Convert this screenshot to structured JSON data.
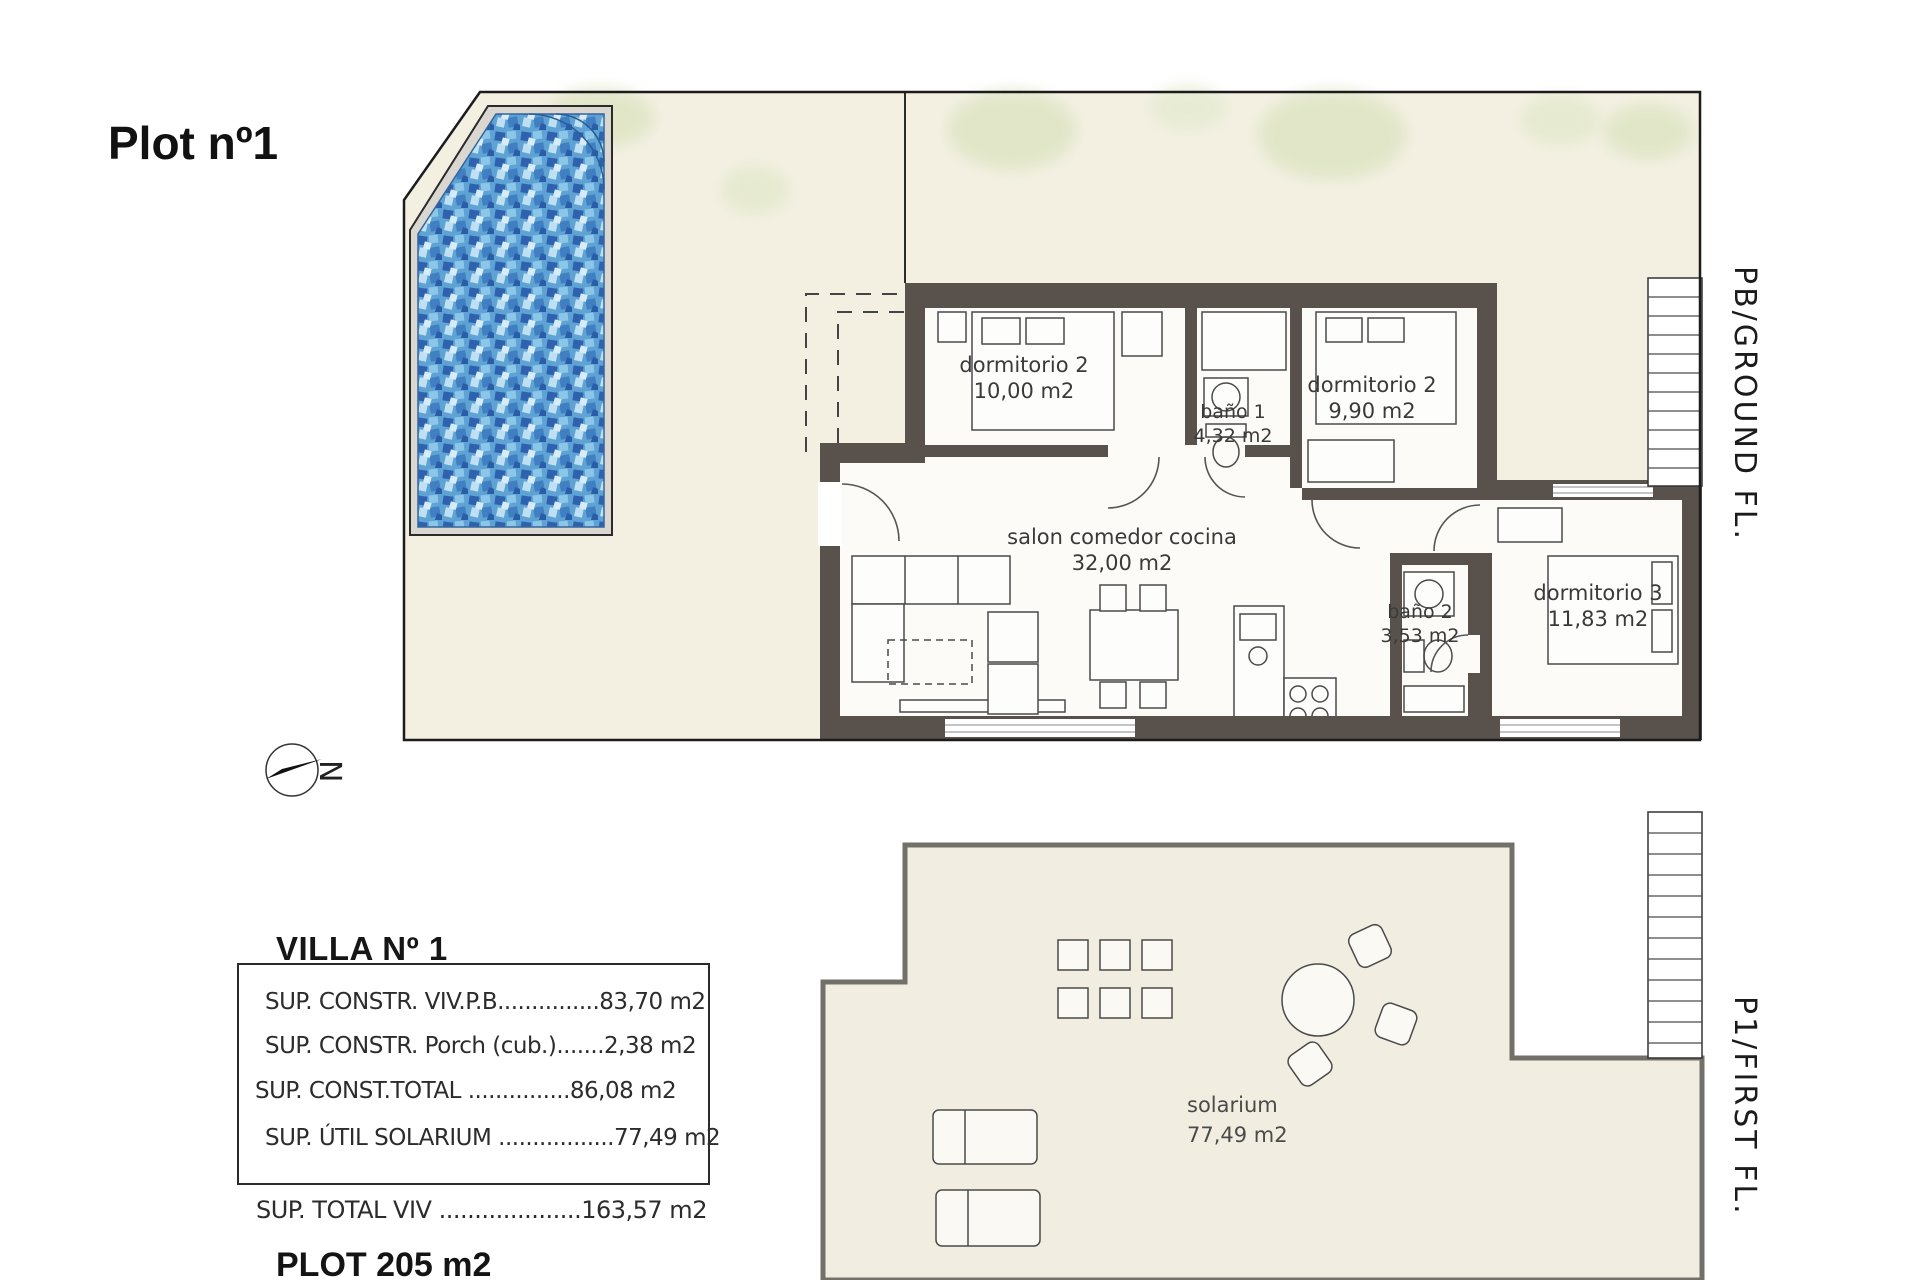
{
  "title": "Plot nº1",
  "ground_floor": {
    "floor_label": "PB/GROUND FL.",
    "compass_letter": "N",
    "rooms": {
      "dorm2_left": {
        "name": "dormitorio 2",
        "area": "10,00 m2"
      },
      "bano1": {
        "name": "baño 1",
        "area": "4,32 m2"
      },
      "dorm2_right": {
        "name": "dormitorio 2",
        "area": "9,90 m2"
      },
      "salon": {
        "name": "salon comedor cocina",
        "area": "32,00 m2"
      },
      "bano2": {
        "name": "baño 2",
        "area": "3,53 m2"
      },
      "dorm3": {
        "name": "dormitorio 3",
        "area": "11,83 m2"
      }
    }
  },
  "first_floor": {
    "floor_label": "P1/FIRST FL.",
    "rooms": {
      "solarium": {
        "name": "solarium",
        "area": "77,49 m2"
      }
    }
  },
  "summary": {
    "heading": "VILLA Nº 1",
    "rows": [
      {
        "label": "SUP. CONSTR. VIV.P.B",
        "leader": "...............",
        "value": "83,70 m2"
      },
      {
        "label": "SUP. CONSTR. Porch (cub.)",
        "leader": ".......",
        "value": "2,38 m2"
      },
      {
        "label": "SUP. CONST.TOTAL",
        "leader": " ...............",
        "value": "86,08 m2"
      },
      {
        "label": "SUP. ÚTIL SOLARIUM",
        "leader": " .................",
        "value": "77,49 m2"
      }
    ],
    "total": {
      "label": "SUP. TOTAL VIV",
      "leader": " ....................",
      "value": "163,57 m2"
    },
    "plot_line": "PLOT 205 m2"
  },
  "colors": {
    "terrace": "#f3f0e2",
    "wall": "#59514b",
    "pool_blue": "#5ea3d4",
    "garden_green": "#dfe5c5"
  }
}
